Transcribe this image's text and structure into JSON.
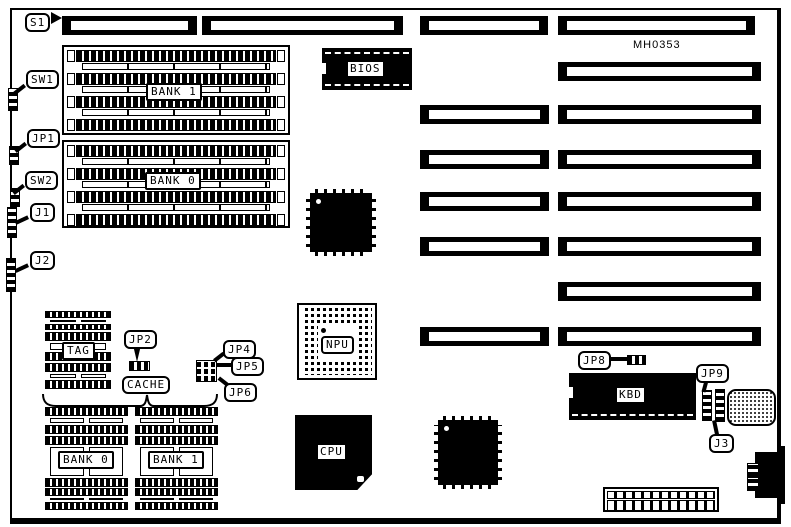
{
  "colors": {
    "ink": "#000000",
    "paper": "#ffffff"
  },
  "board": {
    "part_number": "MH0353"
  },
  "callouts": {
    "s1": "S1",
    "sw1": "SW1",
    "jp1": "JP1",
    "sw2": "SW2",
    "j1": "J1",
    "j2": "J2",
    "jp2": "JP2",
    "jp4": "JP4",
    "jp5": "JP5",
    "jp6": "JP6",
    "jp8": "JP8",
    "jp9": "JP9",
    "j3": "J3"
  },
  "chips": {
    "bios": "BIOS",
    "npu": "NPU",
    "cpu": "CPU",
    "kbd": "KBD",
    "tag": "TAG",
    "cache": "CACHE"
  },
  "memory": {
    "bank1_top": "BANK 1",
    "bank0_top": "BANK 0",
    "bank0_bottom": "BANK 0",
    "bank1_bottom": "BANK 1"
  }
}
